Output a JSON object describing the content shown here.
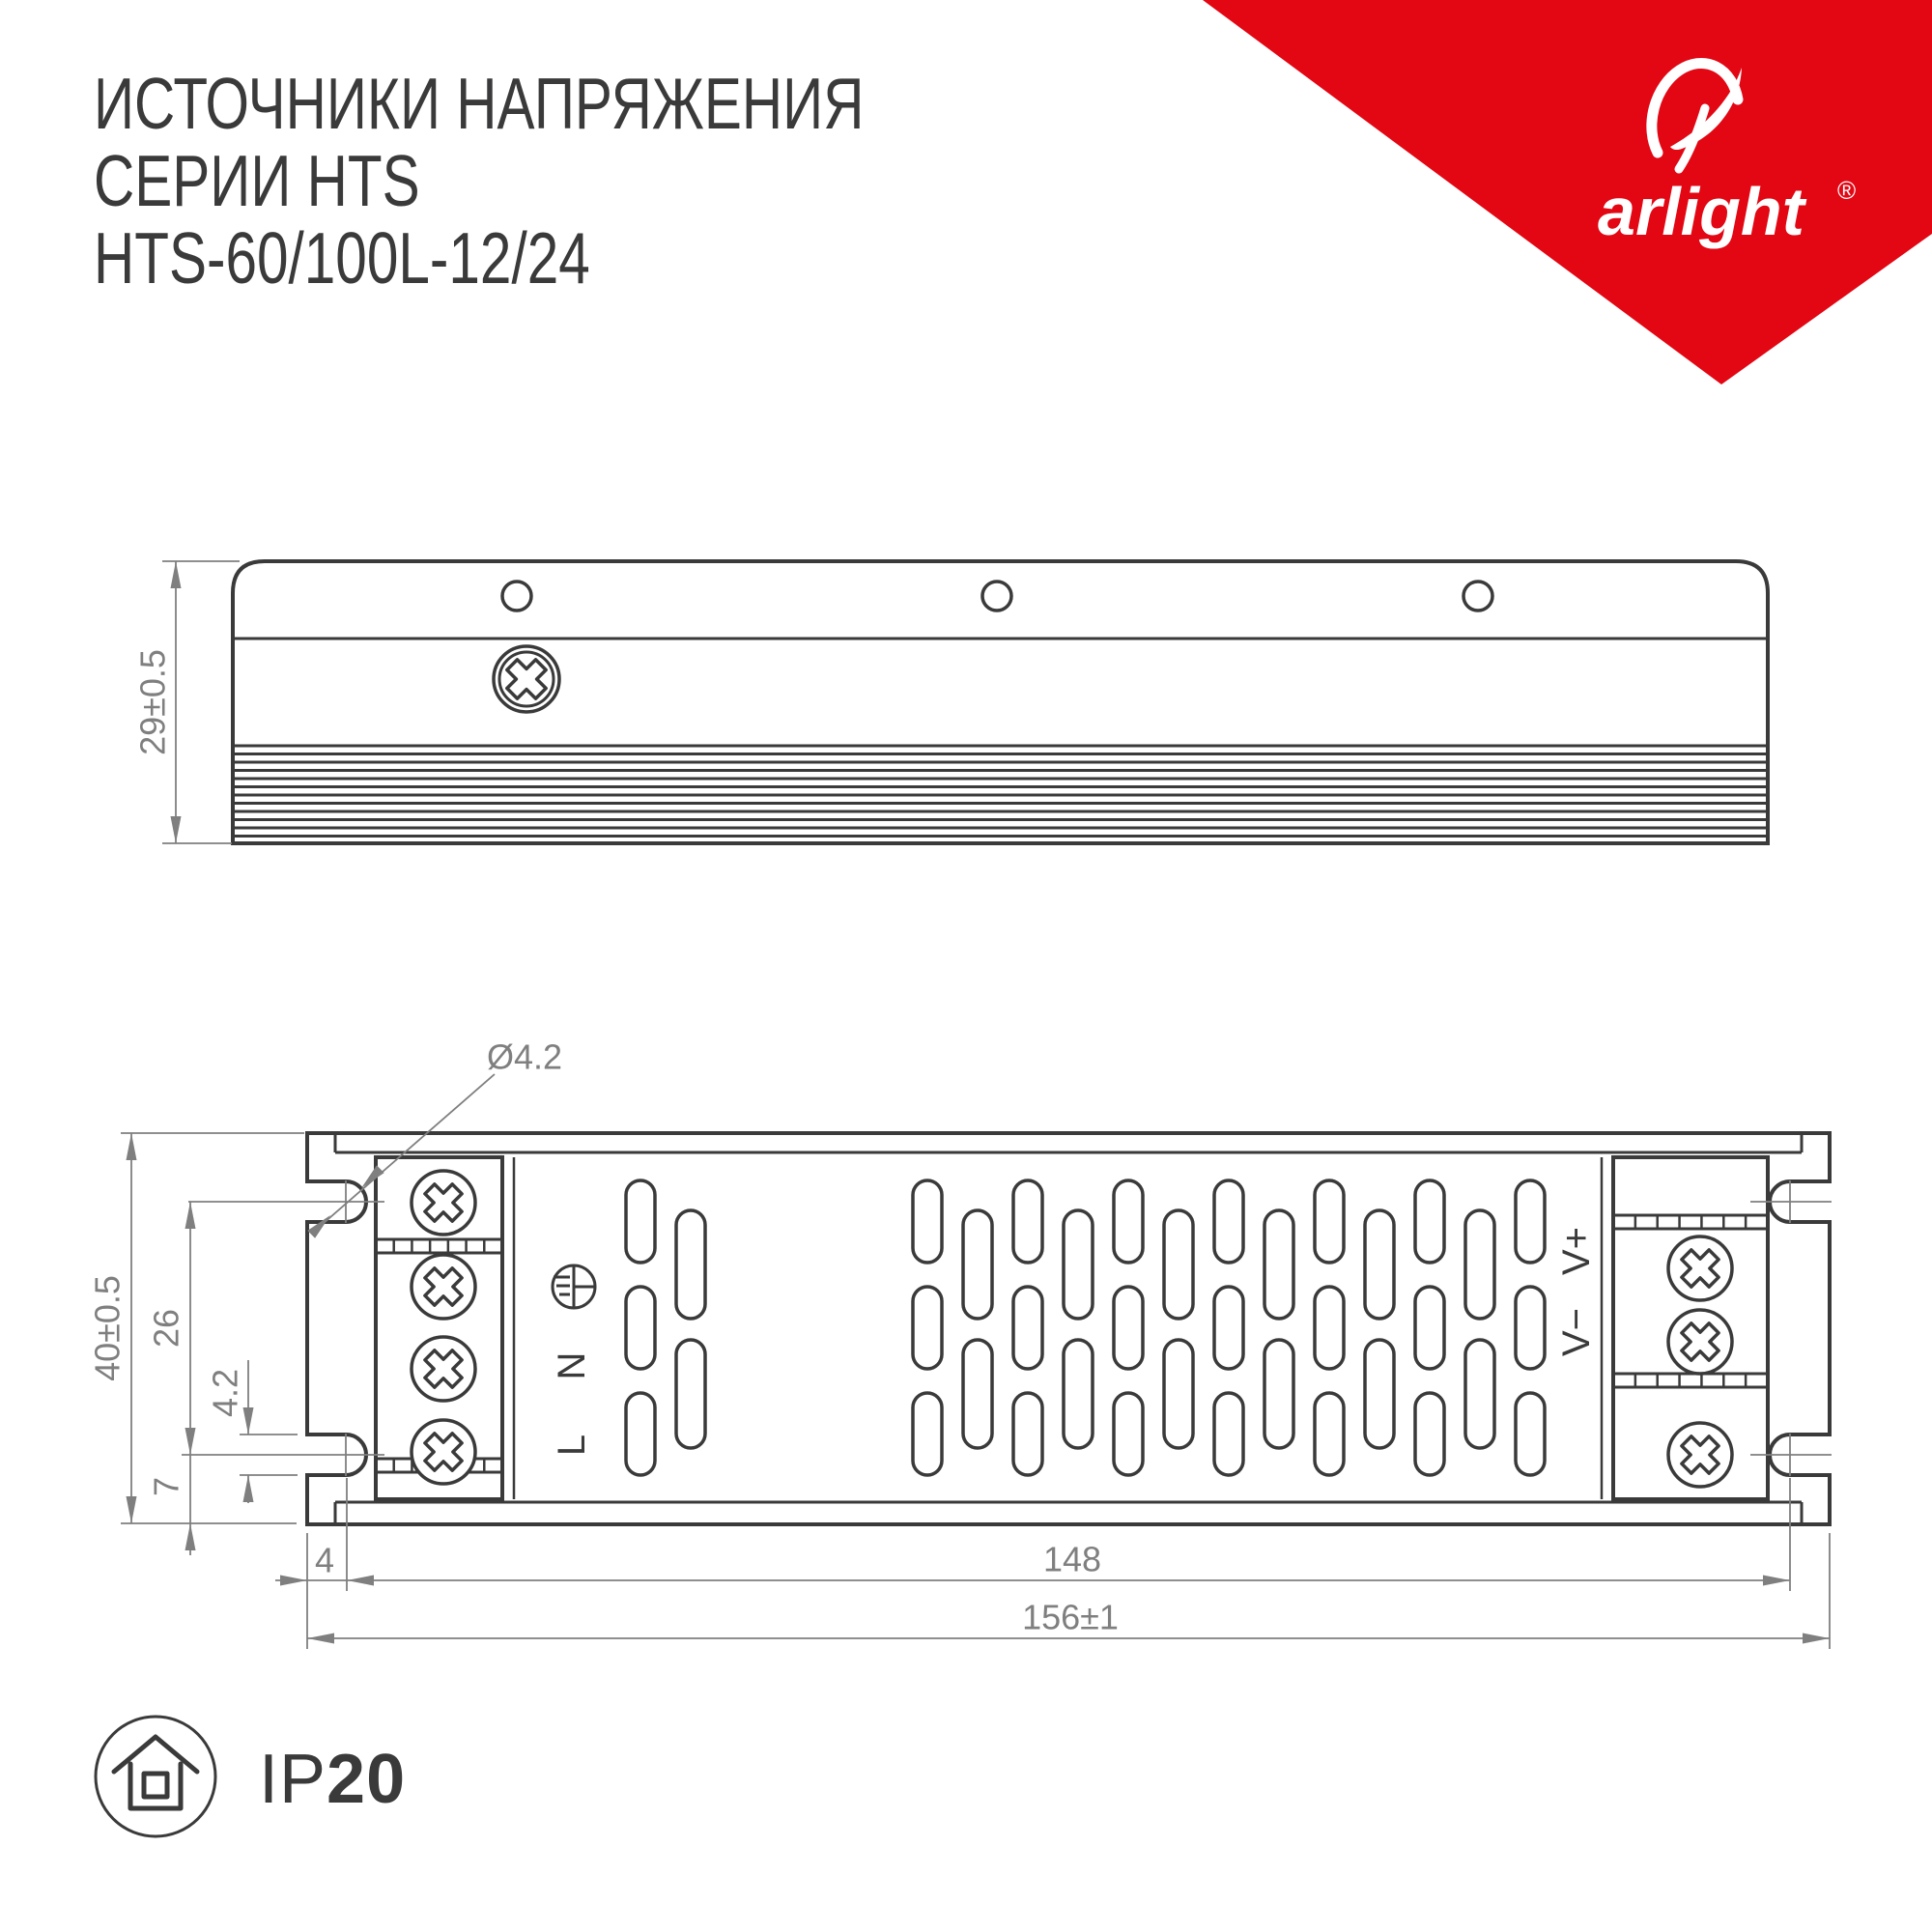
{
  "title": {
    "line1": "ИСТОЧНИКИ НАПРЯЖЕНИЯ",
    "line2": "СЕРИИ HTS",
    "line3": "HTS-60/100L-12/24"
  },
  "logo": {
    "brand": "arlight",
    "registered": "®"
  },
  "side_view": {
    "height_dim": "29±0.5"
  },
  "top_view": {
    "height_dim": "40±0.5",
    "hole_vertical_span_dim": "26",
    "slot_width_dim": "4.2",
    "bottom_offset_dim": "7",
    "edge_offset_dim": "4",
    "hole_span_dim": "148",
    "width_dim": "156±1",
    "hole_diameter_label": "Ø4.2",
    "input_terminals": {
      "neutral": "N",
      "line": "L"
    },
    "output_terminals": {
      "negative": "V−",
      "positive": "V+"
    }
  },
  "footer": {
    "ip_prefix": "IP",
    "ip_value": "20"
  },
  "colors": {
    "brand_red": "#e30613",
    "line_dark": "#3a3a3a",
    "dim_gray": "#7f7f7f"
  }
}
